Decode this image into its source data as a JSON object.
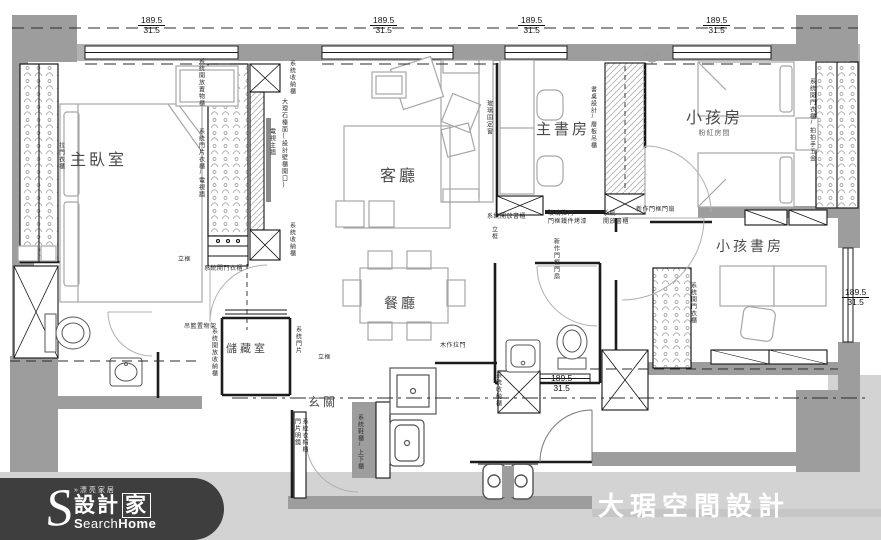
{
  "meta": {
    "type": "apartment floor plan drawing"
  },
  "brand": {
    "company": "大琚空間設計"
  },
  "logo": {
    "initial": "S",
    "prefix": "»漂亮家居",
    "name_left": "設計",
    "name_boxed": "家",
    "latin_light": "earch",
    "latin_bold": "Home",
    "latin_initial": "S"
  },
  "palette": {
    "wall": "#9d9d9d",
    "sill": "#b2b2b2",
    "exterior": "#d3d3d3",
    "line": "#1c1c1c",
    "furniture": "#a6a6a6",
    "logo_bg": "#3e3e3e"
  },
  "rooms": [
    {
      "label": "主臥室",
      "x": 70,
      "y": 146,
      "size": 16
    },
    {
      "label": "客廳",
      "x": 380,
      "y": 162,
      "size": 16
    },
    {
      "label": "主書房",
      "x": 536,
      "y": 118,
      "size": 15
    },
    {
      "label": "小孩房",
      "x": 686,
      "y": 104,
      "size": 16,
      "sub": "粉紅房間"
    },
    {
      "label": "小孩書房",
      "x": 716,
      "y": 236,
      "size": 14
    },
    {
      "label": "餐廳",
      "x": 384,
      "y": 293,
      "size": 14
    },
    {
      "label": "儲藏室",
      "x": 226,
      "y": 340,
      "size": 11
    },
    {
      "label": "玄關",
      "x": 308,
      "y": 393,
      "size": 12
    }
  ],
  "dimensions": [
    {
      "top": "189.5",
      "bottom": "31.5",
      "x": 138,
      "y": 16
    },
    {
      "top": "189.5",
      "bottom": "31.5",
      "x": 370,
      "y": 16
    },
    {
      "top": "189.5",
      "bottom": "31.5",
      "x": 518,
      "y": 16
    },
    {
      "top": "189.5",
      "bottom": "31.5",
      "x": 703,
      "y": 16
    },
    {
      "top": "189.5",
      "bottom": "31.5",
      "x": 842,
      "y": 288
    },
    {
      "top": "189.5",
      "bottom": "31.5",
      "x": 548,
      "y": 374
    }
  ],
  "callouts": [
    {
      "t": "拉門衣櫃",
      "x": 56,
      "y": 142,
      "v": true
    },
    {
      "t": "系統開放置物櫃",
      "x": 196,
      "y": 58,
      "v": true
    },
    {
      "t": "系統門片衣櫃/電視牆",
      "x": 196,
      "y": 128,
      "v": true
    },
    {
      "t": "電視主牆",
      "x": 267,
      "y": 128,
      "v": true
    },
    {
      "t": "大理石檯面(設計壁櫃開口)",
      "x": 279,
      "y": 98,
      "v": true
    },
    {
      "t": "系統收納櫃",
      "x": 287,
      "y": 60,
      "v": true
    },
    {
      "t": "系統收納櫃",
      "x": 287,
      "y": 222,
      "v": true
    },
    {
      "t": "系統開門衣櫃",
      "x": 204,
      "y": 266
    },
    {
      "t": "立框",
      "x": 178,
      "y": 257
    },
    {
      "t": "立框",
      "x": 318,
      "y": 355
    },
    {
      "t": "立框",
      "x": 489,
      "y": 226,
      "v": true
    },
    {
      "t": "吊籃置物架",
      "x": 184,
      "y": 324
    },
    {
      "t": "系統開放收納櫃",
      "x": 209,
      "y": 328,
      "v": true
    },
    {
      "t": "系統門片",
      "x": 293,
      "y": 326,
      "v": true
    },
    {
      "t": "系統開放書櫃",
      "x": 487,
      "y": 214
    },
    {
      "t": "玻璃拉門\n門框鐵件烤漆",
      "x": 548,
      "y": 211
    },
    {
      "t": "系統\n開放書櫃",
      "x": 603,
      "y": 211
    },
    {
      "t": "新作門框門扇",
      "x": 636,
      "y": 207
    },
    {
      "t": "新作門框門扇",
      "x": 551,
      "y": 238,
      "v": true
    },
    {
      "t": "玻璃固定窗",
      "x": 484,
      "y": 100,
      "v": true
    },
    {
      "t": "書桌設計/層板吊櫃",
      "x": 588,
      "y": 86,
      "v": true
    },
    {
      "t": "系統開門衣櫃/拍拍手五金",
      "x": 807,
      "y": 78,
      "v": true
    },
    {
      "t": "系統開門衣櫃",
      "x": 688,
      "y": 282,
      "v": true
    },
    {
      "t": "木作拉門",
      "x": 440,
      "y": 343
    },
    {
      "t": "系統衣帽櫃\n門片明鏡",
      "x": 292,
      "y": 418,
      "v": true
    },
    {
      "t": "系統鞋櫃/上下櫃",
      "x": 355,
      "y": 414,
      "v": true
    },
    {
      "t": "系統收納櫃",
      "x": 493,
      "y": 372,
      "v": true
    }
  ]
}
